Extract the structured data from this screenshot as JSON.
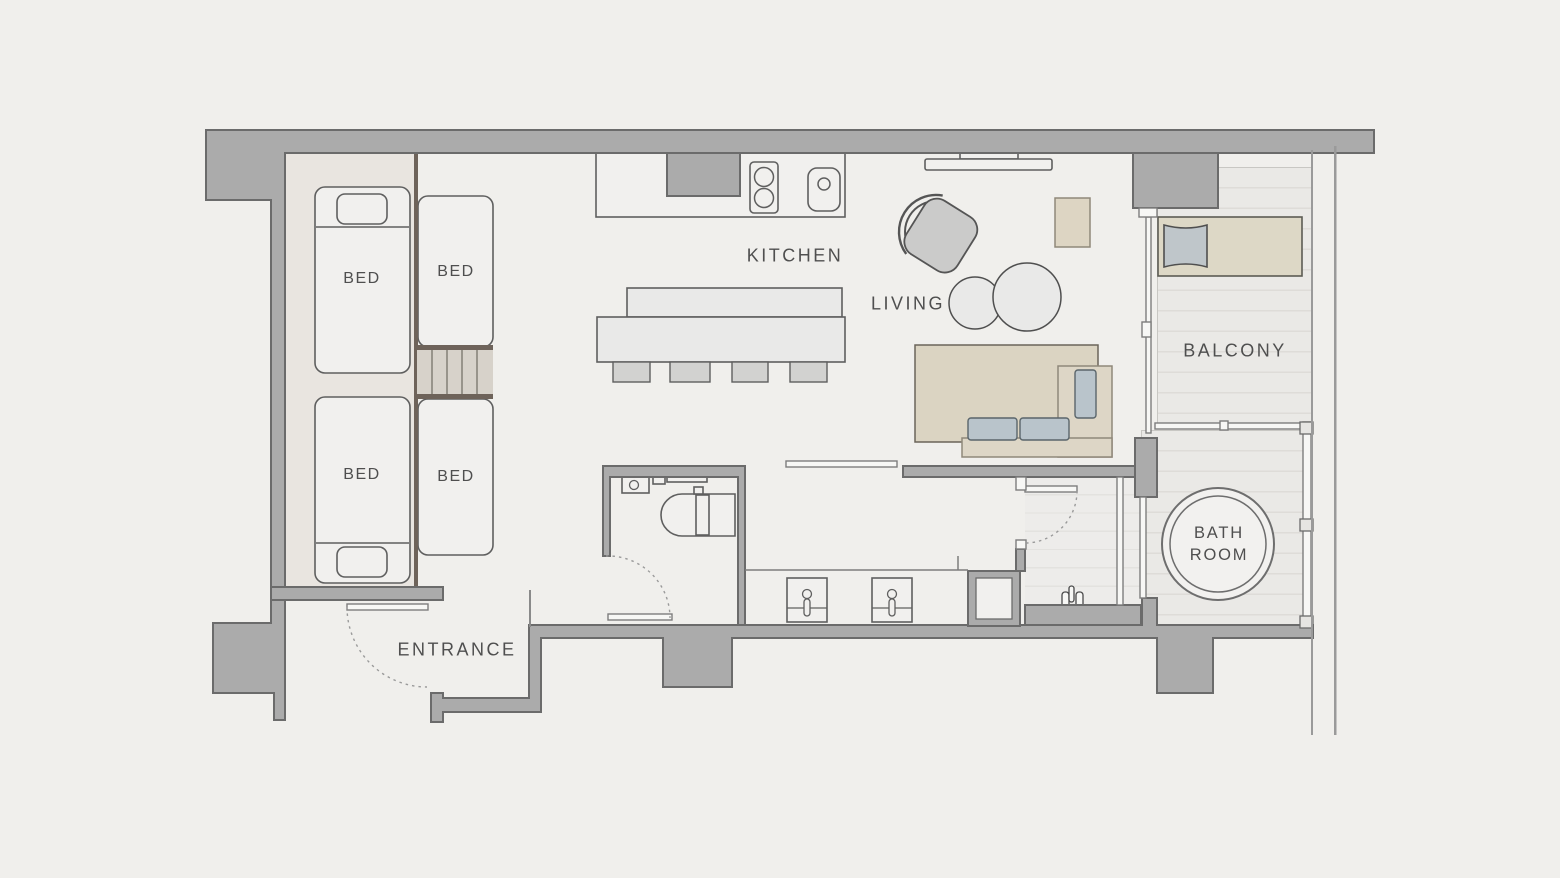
{
  "title": "Apartment floor plan",
  "rooms": {
    "kitchen": {
      "label": "KITCHEN"
    },
    "living": {
      "label": "LIVING"
    },
    "balcony": {
      "label": "BALCONY"
    },
    "bathroom": {
      "label_top": "BATH",
      "label_bottom": "ROOM"
    },
    "entrance": {
      "label": "ENTRANCE"
    },
    "bedroom": {
      "bed_labels": [
        "BED",
        "BED",
        "BED",
        "BED"
      ]
    }
  },
  "colors": {
    "background": "#f0efec",
    "wall_fill": "#ababab",
    "wall_outline": "#6b6b6b",
    "bedroom_floor": "#e9e5e0",
    "deck_floor": "#eae9e6",
    "deck_stripe": "#dedcd8",
    "furniture_fill": "#f1f0ee",
    "furniture_outline": "#5f5f5f",
    "wood_beige": "#ddd6c6",
    "rug_beige": "#dbd4c2",
    "cushion_blue": "#b9c4cb",
    "stair_fill": "#d7d2ca",
    "stair_edge": "#6e635a",
    "label_text": "#4f4f4f"
  }
}
